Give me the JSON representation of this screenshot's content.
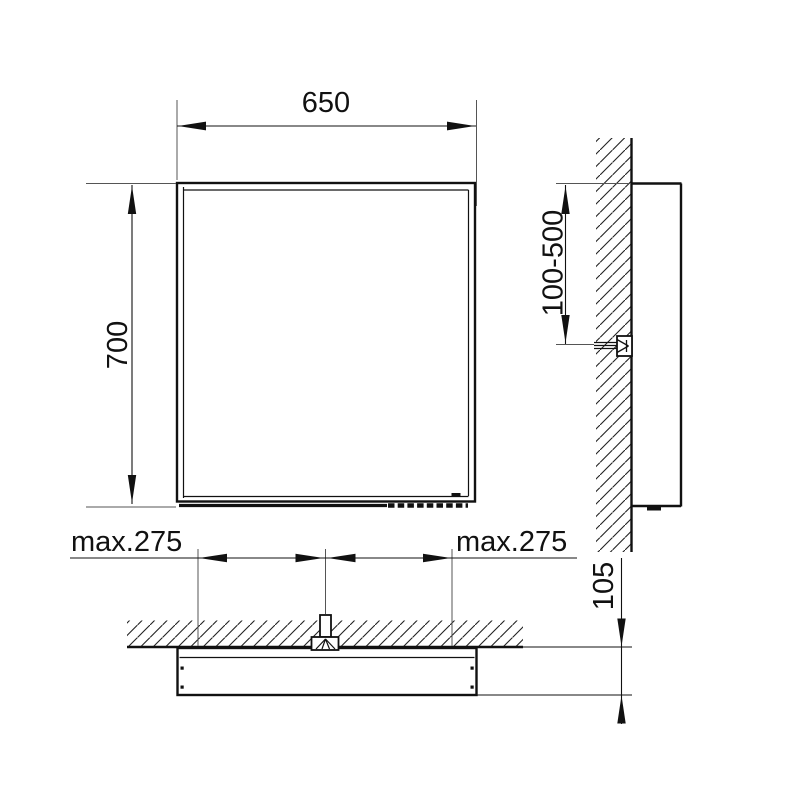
{
  "drawing": {
    "kind": "technical-installation-drawing",
    "views": {
      "front": {
        "width_label": "650",
        "height_label": "700"
      },
      "side": {
        "mounting_range_label": "100-500"
      },
      "plan": {
        "offset_left_label": "max.275",
        "offset_right_label": "max.275",
        "depth_label": "105"
      }
    },
    "colors": {
      "line": "#111111",
      "background": "#ffffff"
    }
  }
}
